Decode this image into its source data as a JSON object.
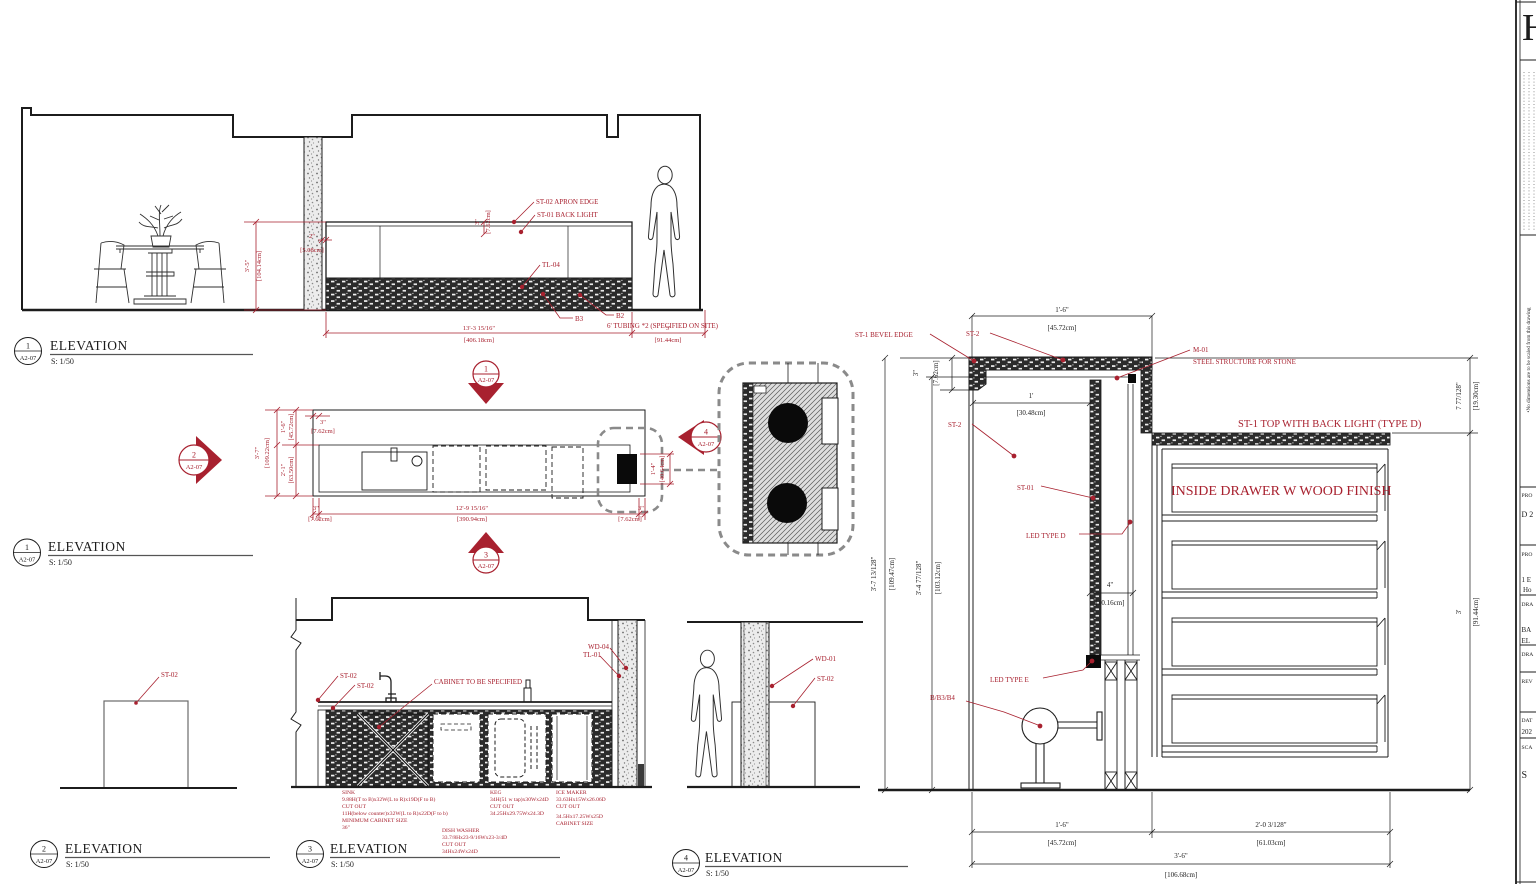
{
  "colors": {
    "red": "#a8212f",
    "black": "#1c1c1c",
    "gray": "#8a8a8a"
  },
  "elev1": {
    "marker": {
      "num": "1",
      "ref": "A2-07"
    },
    "title": "ELEVATION",
    "scale": "S: 1/50",
    "labels": {
      "apron_edge": "ST-02 APRON EDGE",
      "back_light": "ST-01 BACK LIGHT",
      "tl04": "TL-04",
      "b3": "B3",
      "b2": "B2",
      "tubing": "6' TUBING *2 (SPECIFIED ON SITE)"
    },
    "dims": {
      "height_ft": "3'-5\"",
      "height_cm": "[104.14cm]",
      "offset_ft": "2\"",
      "offset_cm": "[5.08cm]",
      "apron_ft": "3\"",
      "apron_cm": "[7.62cm]",
      "length_ft": "13'-3 15/16\"",
      "length_cm": "[406.18cm]",
      "walkway_ft": "3'",
      "walkway_cm": "[91.44cm]"
    }
  },
  "plan": {
    "markers": {
      "top": {
        "num": "1",
        "ref": "A2-07"
      },
      "left": {
        "num": "2",
        "ref": "A2-07"
      },
      "bottom": {
        "num": "3",
        "ref": "A2-07"
      },
      "right": {
        "num": "4",
        "ref": "A2-07"
      }
    },
    "dims": {
      "depth_ft": "3'-7\"",
      "depth_cm": "[109.22cm]",
      "back_ft": "1'-6\"",
      "back_cm": "[45.72cm]",
      "front_ft": "2'-1\"",
      "front_cm": "[63.50cm]",
      "edge_top_ft": "3\"",
      "edge_top_cm": "[7.62cm]",
      "edge_left_ft": "3\"",
      "edge_left_cm": "[7.62cm]",
      "edge_right_ft": "3\"",
      "edge_right_cm": "[7.62cm]",
      "length_ft": "12'-9 15/16\"",
      "length_cm": "[390.94cm]",
      "tap_ft": "1'-4\"",
      "tap_cm": "[40.64cm]"
    },
    "title_marker": {
      "num": "1",
      "ref": "A2-07"
    },
    "title": "ELEVATION",
    "scale": "S: 1/50"
  },
  "elev2": {
    "marker": {
      "num": "2",
      "ref": "A2-07"
    },
    "title": "ELEVATION",
    "scale": "S: 1/50",
    "labels": {
      "st02": "ST-02"
    }
  },
  "elev3": {
    "marker": {
      "num": "3",
      "ref": "A2-07"
    },
    "title": "ELEVATION",
    "scale": "S: 1/50",
    "labels": {
      "st02_a": "ST-02",
      "st02_b": "ST-02",
      "cabinet": "CABINET TO BE SPECIFIED",
      "wd04": "WD-04",
      "tl01": "TL-01"
    },
    "notes": {
      "sink": [
        "SINK",
        "9.88H(T to B)x32W(L to R)x19D(F to B)",
        "CUT OUT",
        "11H(below counter)x32W(L to R)x22D(F to b)",
        "MINIMUM CABINET SIZE",
        "36\""
      ],
      "dishwasher": [
        "DISH WASHER",
        "33.7/8Hx23-9/16Wx23-3/4D",
        "CUT OUT",
        "34Hx24Wx24D"
      ],
      "keg": [
        "KEG",
        "34H(51 w tap)x30Wx24D",
        "CUT OUT",
        "34.25Hx29.75Wx24.3D"
      ],
      "icemaker": [
        "ICE MAKER",
        "33.63Hx15Wx26.06D",
        "CUT OUT",
        "34.5Hx17.25Wx25D",
        "CABINET SIZE"
      ]
    }
  },
  "elev4": {
    "marker": {
      "num": "4",
      "ref": "A2-07"
    },
    "title": "ELEVATION",
    "scale": "S: 1/50",
    "labels": {
      "wd01": "WD-01",
      "st02": "ST-02"
    }
  },
  "detail": {
    "labels": {
      "bevel": "ST-1 BEVEL EDGE",
      "st2_top": "ST-2",
      "m01": "M-01",
      "m01_sub": "STEEL STRUCTURE FOR STONE",
      "st2": "ST-2",
      "st01": "ST-01",
      "led_d": "LED TYPE D",
      "led_e": "LED TYPE E",
      "stools": "B/B3/B4",
      "top_backlight": "ST-1 TOP WITH BACK LIGHT (TYPE D)",
      "drawer": "INSIDE DRAWER W WOOD FINISH"
    },
    "dims": {
      "top_ft": "1'-6\"",
      "top_cm": "[45.72cm]",
      "slab_ft": "3\"",
      "slab_cm": "[7.62cm]",
      "bar_ft": "1'",
      "bar_cm": "[30.48cm]",
      "h1_ft": "3'-7 13/128\"",
      "h1_cm": "[109.47cm]",
      "h2_ft": "3'-4 77/128\"",
      "h2_cm": "[103.12cm]",
      "gap_ft": "4\"",
      "gap_cm": "[10.16cm]",
      "drop_ft": "7 77/128\"",
      "drop_cm": "[19.30cm]",
      "right_ft": "3'",
      "right_cm": "[91.44cm]",
      "b1_ft": "1'-6\"",
      "b1_cm": "[45.72cm]",
      "b2_ft": "2'-0 3/128\"",
      "b2_cm": "[61.03cm]",
      "total_ft": "3'-6\"",
      "total_cm": "[106.68cm]"
    }
  },
  "titleblock": {
    "logo": "H",
    "note": "•No dimensions are to be scaled from this drawing",
    "rows": {
      "r1a": "PRO",
      "r1b": "D 2",
      "r2a": "PRO",
      "r2b": "1 E",
      "r2c": "Ho",
      "r3a": "DRA",
      "r3b": "BA",
      "r3c": "EL",
      "r4a": "DRA",
      "r5a": "REV",
      "r6a": "DAT",
      "r6b": "202",
      "r7a": "SCA",
      "r7b": "S"
    }
  }
}
